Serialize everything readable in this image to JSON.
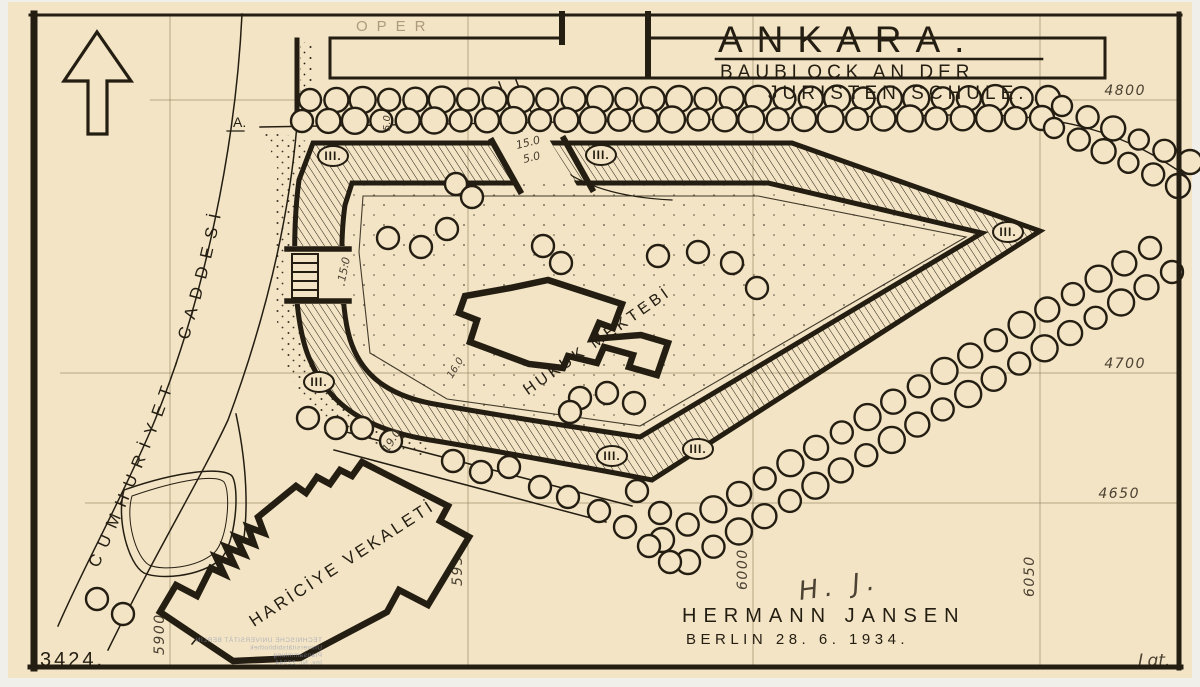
{
  "title": {
    "main": "ANKARA.",
    "sub1": "BAUBLOCK AN DER",
    "sub2": "JURISTEN SCHULE."
  },
  "attribution": {
    "signature": "H. J.",
    "architect": "HERMANN JANSEN",
    "place_date": "BERLIN 28. 6. 1934."
  },
  "meta": {
    "sheet_number": "3424.",
    "corner_mark": "Lgt."
  },
  "labels": {
    "oper": "OPER",
    "street_main": "CUMHURİYET - CADDESİ",
    "street_a": "A.",
    "law_school": "HUKUK MEKTEBİ",
    "foreign_ministry": "HARİCİYE VEKALETİ",
    "floors_marker": "III."
  },
  "colors": {
    "paper": "#f2e4c4",
    "ink": "#241d12",
    "pencil": "#8f7d5e",
    "stamp_blue": "#8b94b5"
  },
  "plan": {
    "grid": {
      "horizontal": [
        {
          "value": "4800",
          "y": 100,
          "x1": 150,
          "label_x": 1146
        },
        {
          "value": "4700",
          "y": 373,
          "x1": 60,
          "label_x": 1146
        },
        {
          "value": "4650",
          "y": 503,
          "x1": 85,
          "label_x": 1140
        }
      ],
      "vertical": [
        {
          "value": "5900",
          "x": 170,
          "label_y": 655
        },
        {
          "value": "5950",
          "x": 468,
          "label_y": 586
        },
        {
          "value": "6000",
          "x": 753,
          "label_y": 590
        },
        {
          "value": "6050",
          "x": 1040,
          "label_y": 597
        }
      ]
    },
    "dimensions": [
      {
        "text": "5.0",
        "x": 390,
        "y": 131,
        "rot": -90,
        "size": 10
      },
      {
        "text": "15.0",
        "x": 517,
        "y": 149,
        "rot": -14,
        "size": 11
      },
      {
        "text": "5.0",
        "x": 524,
        "y": 163,
        "rot": -14,
        "size": 11
      },
      {
        "text": "15.0",
        "x": 345,
        "y": 282,
        "rot": -78,
        "size": 11
      },
      {
        "text": "16.0",
        "x": 452,
        "y": 379,
        "rot": -58,
        "size": 10
      },
      {
        "text": "19.0",
        "x": 388,
        "y": 453,
        "rot": -58,
        "size": 11
      }
    ],
    "floor_markers": [
      [
        333,
        156
      ],
      [
        601,
        155
      ],
      [
        1008,
        232
      ],
      [
        319,
        382
      ],
      [
        612,
        456
      ],
      [
        698,
        449
      ]
    ],
    "trees": {
      "rows": [
        {
          "x1": 310,
          "y1": 100,
          "x2": 1048,
          "y2": 98,
          "n": 29,
          "r": 12
        },
        {
          "x1": 302,
          "y1": 121,
          "x2": 1042,
          "y2": 118,
          "n": 29,
          "r": 12
        },
        {
          "x1": 1062,
          "y1": 106,
          "x2": 1190,
          "y2": 162,
          "n": 6,
          "r": 11
        },
        {
          "x1": 1054,
          "y1": 128,
          "x2": 1178,
          "y2": 186,
          "n": 6,
          "r": 11
        },
        {
          "x1": 1150,
          "y1": 248,
          "x2": 662,
          "y2": 540,
          "n": 20,
          "r": 12
        },
        {
          "x1": 1172,
          "y1": 272,
          "x2": 688,
          "y2": 562,
          "n": 20,
          "r": 12
        }
      ],
      "singles": [
        [
          456,
          184
        ],
        [
          472,
          197
        ],
        [
          388,
          238
        ],
        [
          421,
          247
        ],
        [
          447,
          229
        ],
        [
          543,
          246
        ],
        [
          561,
          263
        ],
        [
          658,
          256
        ],
        [
          698,
          252
        ],
        [
          732,
          263
        ],
        [
          757,
          288
        ],
        [
          580,
          398
        ],
        [
          607,
          393
        ],
        [
          570,
          412
        ],
        [
          634,
          403
        ],
        [
          362,
          428
        ],
        [
          391,
          441
        ],
        [
          453,
          461
        ],
        [
          481,
          472
        ],
        [
          509,
          467
        ],
        [
          540,
          487
        ],
        [
          568,
          497
        ],
        [
          599,
          511
        ],
        [
          625,
          527
        ],
        [
          649,
          546
        ],
        [
          670,
          562
        ],
        [
          637,
          491
        ],
        [
          660,
          513
        ],
        [
          97,
          599
        ],
        [
          123,
          614
        ],
        [
          308,
          418
        ],
        [
          336,
          428
        ]
      ]
    },
    "stamp": {
      "lines": [
        "TECHNISCHE UNIVERSITÄT BERLIN",
        "Universitätsbibliothek",
        "Plansammlung",
        "Inv. Nr. 22344"
      ]
    }
  }
}
